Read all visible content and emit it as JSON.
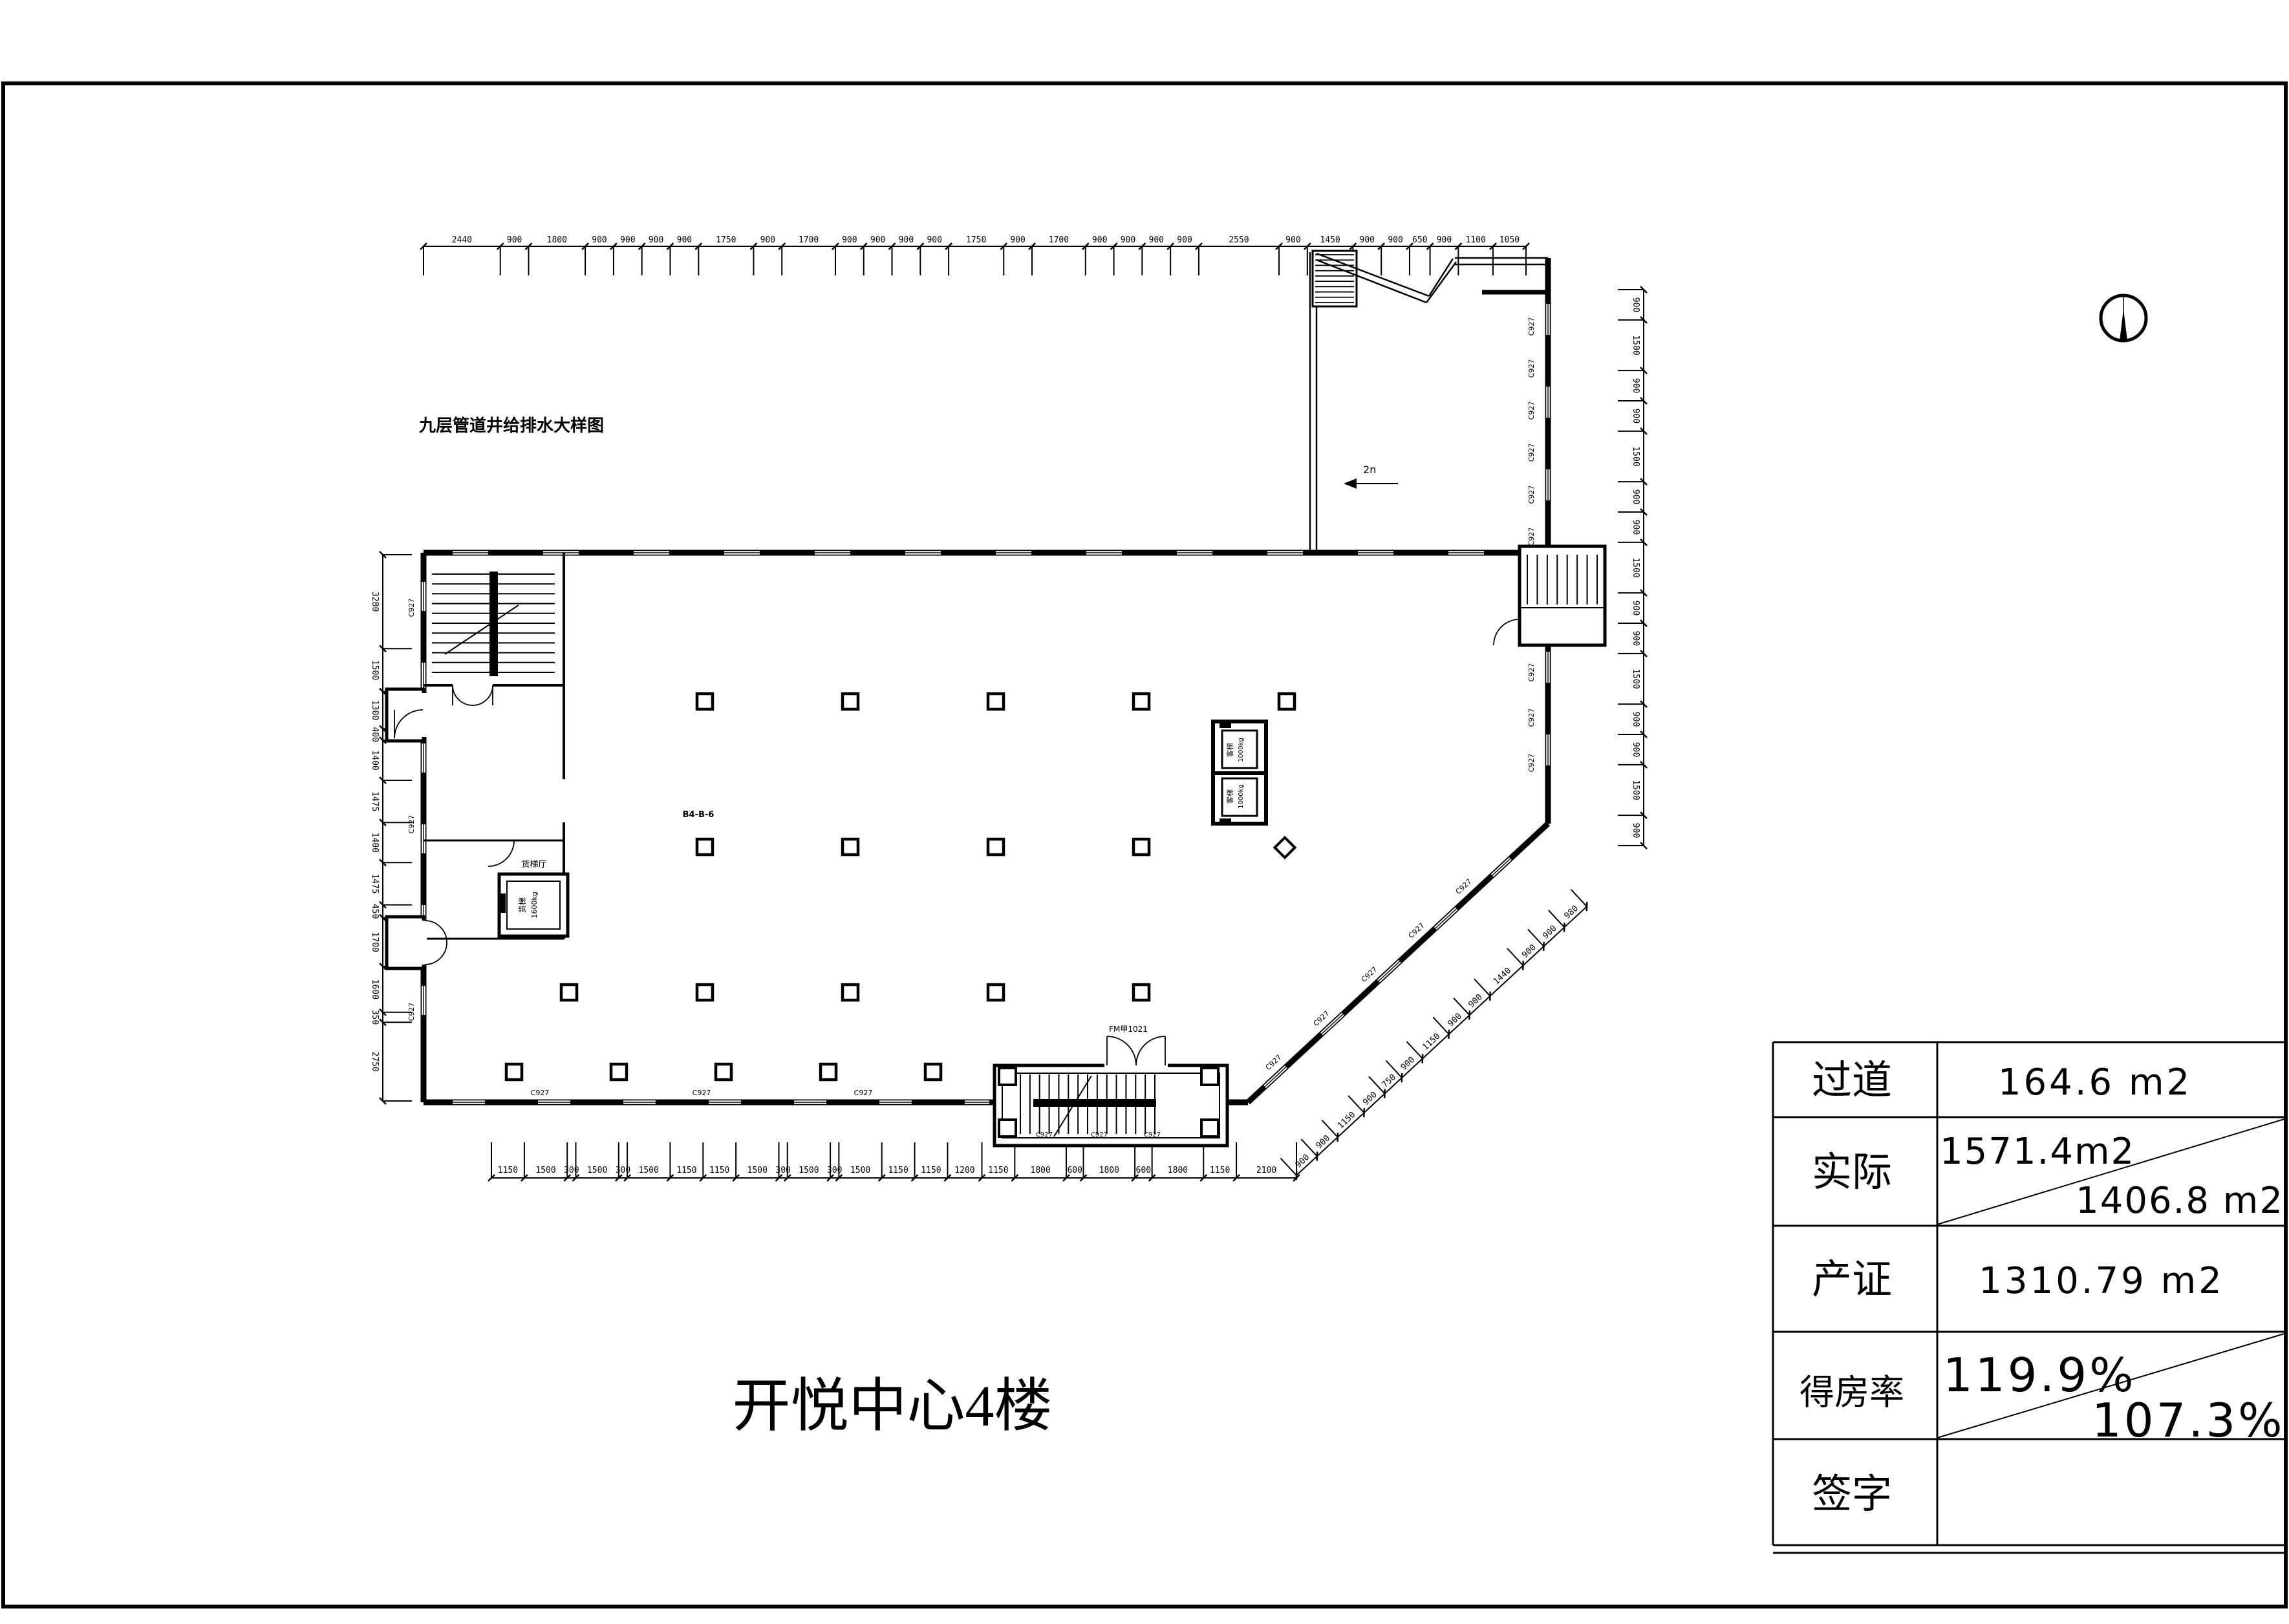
{
  "sheet": {
    "title": "开悦中心4楼",
    "note": "九层管道井给排水大样图"
  },
  "table": {
    "rows": [
      {
        "label": "过道",
        "value": "164.6 m2"
      },
      {
        "label": "实际",
        "value_top": "1571.4m2",
        "value_bottom": "1406.8 m2"
      },
      {
        "label": "产证",
        "value": "1310.79 m2"
      },
      {
        "label": "得房率",
        "value_top": "119.9%",
        "value_bottom": "107.3%"
      },
      {
        "label": "签字",
        "value": ""
      }
    ]
  },
  "plan": {
    "lift_label": "客梯",
    "lift_capacity": "1000kg",
    "freight_label": "货梯",
    "freight_capacity": "1600kg",
    "freight_hall": "货梯厅",
    "escalator_mark": "2n",
    "room_code": "B4-B-6",
    "window_tag": "C927",
    "door_tag": "FM甲1021"
  },
  "dims": {
    "top": [
      "2440",
      "900",
      "1800",
      "900",
      "900",
      "900",
      "900",
      "1750",
      "900",
      "1700",
      "900",
      "900",
      "900",
      "900",
      "1750",
      "900",
      "1700",
      "900",
      "900",
      "900",
      "900",
      "2550",
      "900",
      "1450",
      "900",
      "900",
      "650",
      "900",
      "1100",
      "1050"
    ],
    "bottom": [
      "1150",
      "1500",
      "300",
      "1500",
      "300",
      "1500",
      "1150",
      "1150",
      "1500",
      "300",
      "1500",
      "300",
      "1500",
      "1150",
      "1150",
      "1200",
      "1150",
      "1800",
      "600",
      "1800",
      "600",
      "1800",
      "1150",
      "2100"
    ],
    "left": [
      "3280",
      "1500",
      "1300",
      "400",
      "1400",
      "1475",
      "1400",
      "1475",
      "450",
      "1700",
      "1600",
      "350",
      "2750"
    ],
    "right": [
      "900",
      "1500",
      "900",
      "900",
      "1500",
      "900",
      "900",
      "1500",
      "900",
      "900",
      "1500",
      "900",
      "900",
      "1500",
      "900"
    ],
    "diag": [
      "900",
      "900",
      "1150",
      "900",
      "750",
      "900",
      "1150",
      "900",
      "900",
      "1440",
      "900",
      "900",
      "980"
    ]
  }
}
